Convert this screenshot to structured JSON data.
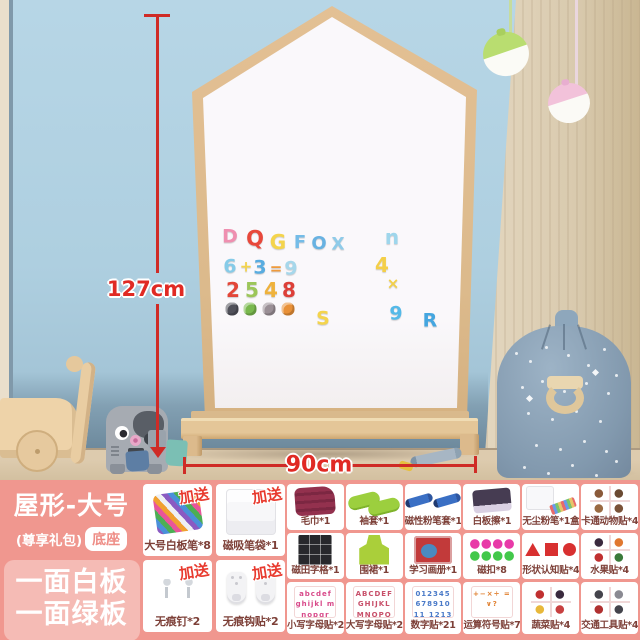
{
  "scene": {
    "height_label": "127cm",
    "width_label": "90cm",
    "colors": {
      "wall_blue": "#aecfe0",
      "wall_beige": "#e7dbc5",
      "floor_wood": "#ddcbae",
      "board_frame": "#dcba8c",
      "board_surface": "#faf8fb",
      "dimension_red": "#cf2b26",
      "lamp_green": "#b9dd70",
      "lamp_pink": "#f2c2da",
      "bag_blue": "#8299ae"
    },
    "magnets": [
      {
        "t": "D",
        "x": 230,
        "y": 237,
        "s": 19,
        "c": "#ef8fb0"
      },
      {
        "t": "Q",
        "x": 255,
        "y": 239,
        "s": 21,
        "c": "#e8483b"
      },
      {
        "t": "G",
        "x": 278,
        "y": 242,
        "s": 20,
        "c": "#f4d44c"
      },
      {
        "t": "F",
        "x": 300,
        "y": 243,
        "s": 18,
        "c": "#74bce8"
      },
      {
        "t": "O",
        "x": 319,
        "y": 244,
        "s": 18,
        "c": "#68b2e2"
      },
      {
        "t": "X",
        "x": 338,
        "y": 245,
        "s": 17,
        "c": "#8fcbe9"
      },
      {
        "t": "n",
        "x": 392,
        "y": 237,
        "s": 20,
        "c": "#9ed6ec"
      },
      {
        "t": "6",
        "x": 230,
        "y": 267,
        "s": 19,
        "c": "#86cbe8"
      },
      {
        "t": "+",
        "x": 246,
        "y": 267,
        "s": 15,
        "c": "#f4d44c"
      },
      {
        "t": "3",
        "x": 260,
        "y": 268,
        "s": 19,
        "c": "#58ace0"
      },
      {
        "t": "=",
        "x": 276,
        "y": 269,
        "s": 15,
        "c": "#ef9a3c"
      },
      {
        "t": "9",
        "x": 291,
        "y": 269,
        "s": 19,
        "c": "#a6d7eb"
      },
      {
        "t": "4",
        "x": 382,
        "y": 265,
        "s": 20,
        "c": "#f4cf48"
      },
      {
        "t": "2",
        "x": 233,
        "y": 290,
        "s": 20,
        "c": "#e34638"
      },
      {
        "t": "5",
        "x": 252,
        "y": 290,
        "s": 20,
        "c": "#9cc659"
      },
      {
        "t": "4",
        "x": 271,
        "y": 290,
        "s": 20,
        "c": "#efb23c"
      },
      {
        "t": "8",
        "x": 289,
        "y": 290,
        "s": 20,
        "c": "#dd3f38"
      },
      {
        "t": "×",
        "x": 393,
        "y": 284,
        "s": 15,
        "c": "#f2d04a"
      },
      {
        "t": "S",
        "x": 323,
        "y": 319,
        "s": 19,
        "c": "#f4d44c"
      },
      {
        "t": "9",
        "x": 396,
        "y": 314,
        "s": 19,
        "c": "#54b9e8"
      },
      {
        "t": "R",
        "x": 430,
        "y": 321,
        "s": 19,
        "c": "#44a6e0"
      }
    ],
    "animal_magnets": [
      {
        "name": "panda",
        "x": 232,
        "y": 309,
        "c": "#50505a"
      },
      {
        "name": "frog",
        "x": 250,
        "y": 309,
        "c": "#79b84e"
      },
      {
        "name": "raccoon",
        "x": 269,
        "y": 309,
        "c": "#9a8f96"
      },
      {
        "name": "lion",
        "x": 288,
        "y": 309,
        "c": "#e89038"
      }
    ]
  },
  "panel": {
    "title": "屋形-大号",
    "subtitle": "(尊享礼包)",
    "base_badge": "底座",
    "feature_line1": "一面白板",
    "feature_line2": "一面绿板",
    "bonus_label": "加送",
    "colors": {
      "panel_pink": "#f0978f",
      "feature_box_pink": "#f5bbb5",
      "bonus_red": "#e83a2e",
      "label_maroon": "#7d4038"
    },
    "left_cells": [
      {
        "label": "大号白板笔*8",
        "icon": "markers",
        "bonus": true
      },
      {
        "label": "磁吸笔袋*1",
        "icon": "pen-pouch",
        "bonus": true
      },
      {
        "label": "无痕钉*2",
        "icon": "nails",
        "bonus": true
      },
      {
        "label": "无痕钩贴*2",
        "icon": "hooks",
        "bonus": true
      }
    ],
    "grid_cells": [
      {
        "label": "毛巾*1",
        "icon": "towel"
      },
      {
        "label": "袖套*1",
        "icon": "sleeves"
      },
      {
        "label": "磁性粉笔套*1",
        "icon": "chalk-holder"
      },
      {
        "label": "白板擦*1",
        "icon": "eraser"
      },
      {
        "label": "无尘粉笔*1盒",
        "icon": "chalk-box"
      },
      {
        "label": "卡通动物贴*4",
        "icon": "animal-stickers"
      },
      {
        "label": "磁田字格*1",
        "icon": "grid-board"
      },
      {
        "label": "围裙*1",
        "icon": "apron"
      },
      {
        "label": "学习画册*1",
        "icon": "picture-book"
      },
      {
        "label": "磁扣*8",
        "icon": "magnets"
      },
      {
        "label": "形状认知贴*4",
        "icon": "shape-stickers"
      },
      {
        "label": "水果贴*4",
        "icon": "fruit-stickers"
      },
      {
        "label": "小写字母贴*26",
        "icon": "lowercase-card",
        "thumb_text": "abcdef ghijkl mnopqr"
      },
      {
        "label": "大写字母贴*26",
        "icon": "uppercase-card",
        "thumb_text": "ABCDEF GHIJKL MNOPQR"
      },
      {
        "label": "数字贴*21",
        "icon": "number-card",
        "thumb_text": "012345 67891011 1213"
      },
      {
        "label": "运算符号贴*7",
        "icon": "operator-card",
        "thumb_text": "+−×÷ =∨?"
      },
      {
        "label": "蔬菜贴*4",
        "icon": "vegetable-stickers"
      },
      {
        "label": "交通工具贴*4",
        "icon": "vehicle-stickers"
      }
    ]
  }
}
